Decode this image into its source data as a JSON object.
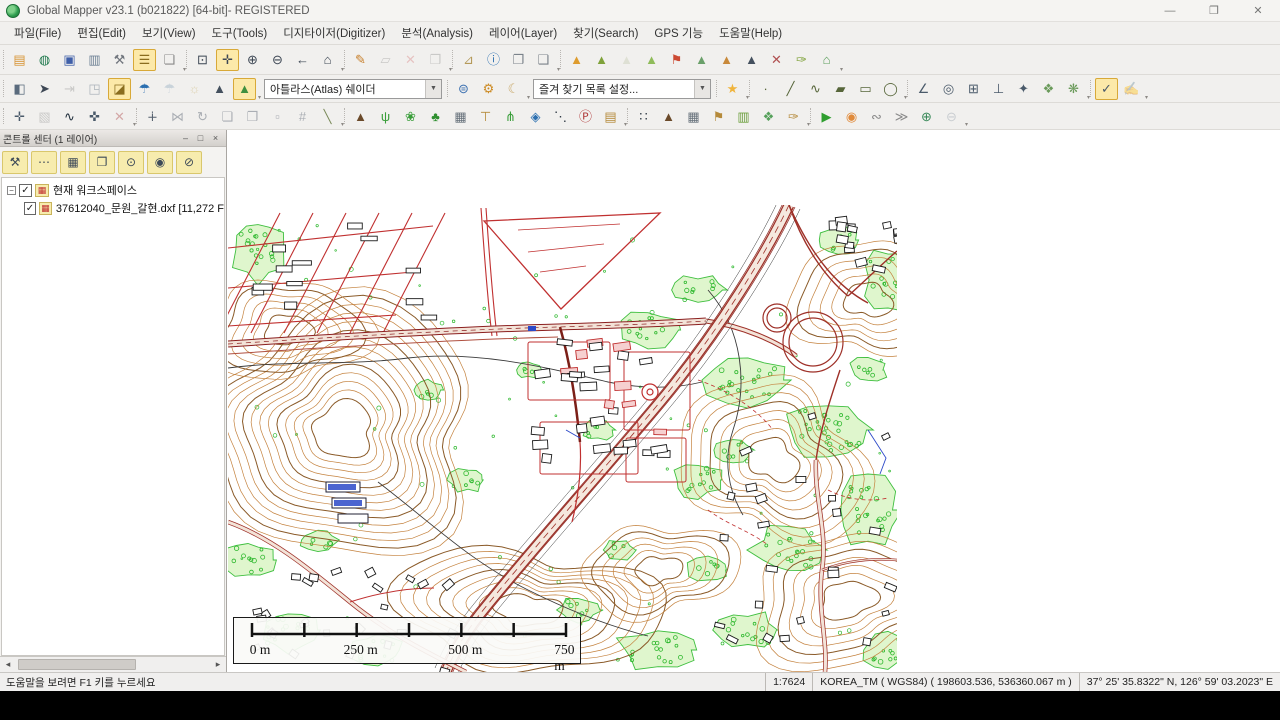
{
  "window": {
    "title": "Global Mapper v23.1 (b021822) [64-bit]- REGISTERED",
    "controls": {
      "minimize": "—",
      "restore": "❐",
      "close": "✕"
    }
  },
  "menu": {
    "items": [
      {
        "key": "file",
        "label": "파일(File)"
      },
      {
        "key": "edit",
        "label": "편집(Edit)"
      },
      {
        "key": "view",
        "label": "보기(View)"
      },
      {
        "key": "tools",
        "label": "도구(Tools)"
      },
      {
        "key": "digitizer",
        "label": "디지타이저(Digitizer)"
      },
      {
        "key": "analysis",
        "label": "분석(Analysis)"
      },
      {
        "key": "layer",
        "label": "레이어(Layer)"
      },
      {
        "key": "search",
        "label": "찾기(Search)"
      },
      {
        "key": "gps",
        "label": "GPS 기능"
      },
      {
        "key": "help",
        "label": "도움말(Help)"
      }
    ]
  },
  "toolbars": {
    "row1": [
      {
        "type": "group",
        "items": [
          {
            "n": "open-file",
            "g": "▤",
            "c": "#d79333"
          },
          {
            "n": "open-online-data",
            "g": "◍",
            "c": "#1f7a4d"
          },
          {
            "n": "save-workspace",
            "g": "▣",
            "c": "#3f5fa8"
          },
          {
            "n": "map-view",
            "g": "▥",
            "c": "#6b7f93"
          },
          {
            "n": "configuration",
            "g": "⚒",
            "c": "#70757d"
          },
          {
            "n": "control-center",
            "g": "☰",
            "c": "#8a6d1f",
            "a": true
          },
          {
            "n": "overlay-control-center",
            "g": "❏",
            "c": "#8a8a8a"
          }
        ]
      },
      {
        "type": "group",
        "items": [
          {
            "n": "zoom-box",
            "g": "⊡",
            "c": "#3d4754"
          },
          {
            "n": "pan-grab",
            "g": "✛",
            "c": "#3d4754",
            "a": true
          },
          {
            "n": "zoom-in",
            "g": "⊕",
            "c": "#3d4754"
          },
          {
            "n": "zoom-out",
            "g": "⊖",
            "c": "#3d4754"
          },
          {
            "n": "previous-view",
            "g": "←",
            "c": "#3d4754"
          },
          {
            "n": "full-view-home",
            "g": "⌂",
            "c": "#3d4754"
          }
        ]
      },
      {
        "type": "group",
        "items": [
          {
            "n": "digitizer-edit",
            "g": "✎",
            "c": "#c77f2a"
          },
          {
            "n": "edit-geometry",
            "g": "▱",
            "c": "#9a9a9a",
            "d": true
          },
          {
            "n": "delete-feature",
            "g": "✕",
            "c": "#d98c8c",
            "d": true
          },
          {
            "n": "multi-select",
            "g": "❒",
            "c": "#9a9a9a",
            "d": true
          }
        ]
      },
      {
        "type": "group",
        "items": [
          {
            "n": "measure",
            "g": "⊿",
            "c": "#b59a5a"
          },
          {
            "n": "feature-info",
            "g": "ⓘ",
            "c": "#2b6fb0"
          },
          {
            "n": "picture-info",
            "g": "❐",
            "c": "#7a828a"
          },
          {
            "n": "attribute-editor",
            "g": "❑",
            "c": "#7a828a"
          }
        ]
      },
      {
        "type": "group",
        "items": [
          {
            "n": "show-3d-view",
            "g": "▲",
            "c": "#de9c2e"
          },
          {
            "n": "path-profile",
            "g": "▲",
            "c": "#7fa23a"
          },
          {
            "n": "line-of-sight",
            "g": "▲",
            "c": "#c9cdb6",
            "d": true
          },
          {
            "n": "watershed",
            "g": "▲",
            "c": "#8fbc5a"
          },
          {
            "n": "view-shed-flag",
            "g": "⚑",
            "c": "#cc4a33"
          },
          {
            "n": "water-level-rise",
            "g": "▲",
            "c": "#6aa06a"
          },
          {
            "n": "contour-generation",
            "g": "▲",
            "c": "#c8893a"
          },
          {
            "n": "terrain-shading",
            "g": "▲",
            "c": "#44505e"
          },
          {
            "n": "clear-terrain",
            "g": "✕",
            "c": "#b05050"
          },
          {
            "n": "terrain-paint",
            "g": "✑",
            "c": "#7fa23a"
          },
          {
            "n": "3d-site-model",
            "g": "⌂",
            "c": "#5a9e5a"
          }
        ]
      }
    ],
    "row2": [
      {
        "type": "group",
        "items": [
          {
            "n": "split-screen",
            "g": "◧",
            "c": "#5a6b7d"
          },
          {
            "n": "gps-orientation",
            "g": "➤",
            "c": "#3d4754"
          },
          {
            "n": "step-playback",
            "g": "⇥",
            "c": "#9a9a9a",
            "d": true
          },
          {
            "n": "3d-path-view",
            "g": "◳",
            "c": "#5a6b7d",
            "d": true
          },
          {
            "n": "swipe-compare",
            "g": "◪",
            "c": "#8a6d1f",
            "a": true
          },
          {
            "n": "watershed-rain",
            "g": "☂",
            "c": "#2b6fb0"
          },
          {
            "n": "rain-simulation",
            "g": "☂",
            "c": "#9ab0c4",
            "d": true
          },
          {
            "n": "sun-shading",
            "g": "☼",
            "c": "#c8b06a",
            "d": true
          },
          {
            "n": "hill-shading",
            "g": "▲",
            "c": "#44505e"
          },
          {
            "n": "atlas-shader-mountain",
            "g": "▲",
            "c": "#3f8f3f",
            "a": true
          }
        ]
      },
      {
        "type": "combo",
        "n": "shader-combo",
        "value": "아틀라스(Atlas) 쉐이더"
      },
      {
        "type": "group",
        "items": [
          {
            "n": "online-sources-globe",
            "g": "⊜",
            "c": "#3a6fb0"
          },
          {
            "n": "shader-options-gear",
            "g": "⚙",
            "c": "#cc8a22"
          },
          {
            "n": "day-night-toggle-moon",
            "g": "☾",
            "c": "#c9a96a"
          }
        ]
      },
      {
        "type": "combo",
        "n": "favorites-combo",
        "value": "즐겨 찾기 목록 설정..."
      },
      {
        "type": "group",
        "items": [
          {
            "n": "favorite-views-star",
            "g": "★",
            "c": "#f0b43c"
          }
        ]
      },
      {
        "type": "group",
        "items": [
          {
            "n": "create-point-feature",
            "g": "∙",
            "c": "#57663a"
          },
          {
            "n": "create-line-feature",
            "g": "╱",
            "c": "#57663a"
          },
          {
            "n": "create-freehand-feature",
            "g": "∿",
            "c": "#57663a"
          },
          {
            "n": "create-area-feature",
            "g": "▰",
            "c": "#57663a"
          },
          {
            "n": "create-rectangle-feature",
            "g": "▭",
            "c": "#57663a"
          },
          {
            "n": "create-ellipse-feature",
            "g": "◯",
            "c": "#57663a"
          }
        ]
      },
      {
        "type": "group",
        "items": [
          {
            "n": "angle-measure-create",
            "g": "∠",
            "c": "#4a5a6a"
          },
          {
            "n": "range-rings",
            "g": "◎",
            "c": "#4a5a6a"
          },
          {
            "n": "grid-create",
            "g": "⊞",
            "c": "#4a5a6a"
          },
          {
            "n": "elevation-post",
            "g": "⊥",
            "c": "#4a5a6a"
          },
          {
            "n": "spot-symbol",
            "g": "✦",
            "c": "#4a5a6a"
          },
          {
            "n": "texture-fill",
            "g": "❖",
            "c": "#6a9a5a"
          },
          {
            "n": "merge-areas",
            "g": "❋",
            "c": "#6a9a5a"
          }
        ]
      },
      {
        "type": "group",
        "items": [
          {
            "n": "digitizer-select-check",
            "g": "✓",
            "c": "#4a5a6a",
            "a": true
          },
          {
            "n": "signature-stamp",
            "g": "✍",
            "c": "#9aa4ae",
            "d": true
          }
        ]
      }
    ],
    "row3": [
      {
        "type": "group",
        "items": [
          {
            "n": "move-feature",
            "g": "✛",
            "c": "#4a5a6a"
          },
          {
            "n": "image-rectify",
            "g": "▧",
            "c": "#9a9a9a",
            "d": true
          },
          {
            "n": "freehand-scribble",
            "g": "∿",
            "c": "#22303d"
          },
          {
            "n": "shift-vertices",
            "g": "✜",
            "c": "#4a5a6a"
          },
          {
            "n": "delete-vertex",
            "g": "✕",
            "c": "#b05050",
            "d": true
          }
        ]
      },
      {
        "type": "group",
        "items": [
          {
            "n": "add-vertex",
            "g": "∔",
            "c": "#55606e"
          },
          {
            "n": "join-lines",
            "g": "⋈",
            "c": "#55606e",
            "d": true
          },
          {
            "n": "rotate-feature",
            "g": "↻",
            "c": "#55606e",
            "d": true
          },
          {
            "n": "copy-feature",
            "g": "❏",
            "c": "#55606e",
            "d": true
          },
          {
            "n": "offset-feature",
            "g": "❐",
            "c": "#55606e",
            "d": true
          },
          {
            "n": "duplicate-feature",
            "g": "▫",
            "c": "#55606e",
            "d": true
          },
          {
            "n": "snap-to-grid",
            "g": "#",
            "c": "#55606e",
            "d": true
          },
          {
            "n": "draw-split-line",
            "g": "╲",
            "c": "#7a8a5a"
          }
        ]
      },
      {
        "type": "group",
        "items": [
          {
            "n": "symbol-mountain",
            "g": "▲",
            "c": "#6b4a2a"
          },
          {
            "n": "symbol-grass",
            "g": "ψ",
            "c": "#3a9e3a"
          },
          {
            "n": "symbol-shrub",
            "g": "❀",
            "c": "#3a9e3a"
          },
          {
            "n": "symbol-tree",
            "g": "♣",
            "c": "#2f8f2f"
          },
          {
            "n": "symbol-building",
            "g": "▦",
            "c": "#66707a"
          },
          {
            "n": "symbol-streetlamp",
            "g": "⊤",
            "c": "#b58a3a"
          },
          {
            "n": "symbol-palm",
            "g": "⋔",
            "c": "#3a9e3a"
          },
          {
            "n": "symbol-water-drop",
            "g": "◈",
            "c": "#2b6fb0"
          },
          {
            "n": "symbol-dotted-line",
            "g": "⋱",
            "c": "#2f3a44"
          },
          {
            "n": "symbol-parking",
            "g": "Ⓟ",
            "c": "#b03a3a"
          },
          {
            "n": "symbol-fence",
            "g": "▤",
            "c": "#b58a3a"
          }
        ]
      },
      {
        "type": "group",
        "items": [
          {
            "n": "label-point",
            "g": "∷",
            "c": "#2f3a44"
          },
          {
            "n": "label-mountain",
            "g": "▲",
            "c": "#6b4a2a"
          },
          {
            "n": "label-building",
            "g": "▦",
            "c": "#66707a"
          },
          {
            "n": "flag-pole",
            "g": "⚑",
            "c": "#b58a3a"
          },
          {
            "n": "billboard-panel",
            "g": "▥",
            "c": "#6a9e3a"
          },
          {
            "n": "texture-puzzle",
            "g": "❖",
            "c": "#55a05a"
          },
          {
            "n": "paint-brush",
            "g": "✑",
            "c": "#b58a3a"
          }
        ]
      },
      {
        "type": "group",
        "items": [
          {
            "n": "play-animation",
            "g": "▶",
            "c": "#2f9e2f"
          },
          {
            "n": "stop-animation",
            "g": "◉",
            "c": "#e08a3a"
          },
          {
            "n": "speed-slow-turtle",
            "g": "∾",
            "c": "#8a8a8a"
          },
          {
            "n": "speed-fast-rabbit",
            "g": "≫",
            "c": "#8a8a8a"
          },
          {
            "n": "zoom-in-animation",
            "g": "⊕",
            "c": "#3a8a5a"
          },
          {
            "n": "zoom-out-animation",
            "g": "⊖",
            "c": "#9aa4ae",
            "d": true
          }
        ]
      }
    ]
  },
  "control_center": {
    "title": "콘트롤 센터 (1 레이어)",
    "buttons": [
      {
        "n": "layer-options",
        "g": "⚒"
      },
      {
        "n": "layer-metadata",
        "g": "⋯"
      },
      {
        "n": "attribute-table",
        "g": "▦"
      },
      {
        "n": "duplicate-layer",
        "g": "❐"
      },
      {
        "n": "zoom-to-layer",
        "g": "⊙"
      },
      {
        "n": "show-layer-eye",
        "g": "◉"
      },
      {
        "n": "hide-layer-eye",
        "g": "⊘"
      }
    ],
    "window_buttons": {
      "minimize": "–",
      "restore": "□",
      "close": "×"
    },
    "tree": [
      {
        "label": "현재 워크스페이스",
        "checked": "✓",
        "indent": 0
      },
      {
        "label": "37612040_문원_갈현.dxf [11,272 F",
        "checked": "✓",
        "indent": 1
      }
    ]
  },
  "map": {
    "scale_labels": [
      "0 m",
      "250 m",
      "500 m",
      "750 m"
    ],
    "colors": {
      "contour": "#c4823e",
      "index_contour": "#8a5a28",
      "road_casing": "#9e3028",
      "road_fill": "#f3e3d8",
      "minor_road": "#c03030",
      "vegetation_fill": "#d9f5c4",
      "vegetation_stroke": "#3fbf3f",
      "building": "#1a1a1a",
      "water_blue": "#2b49c8"
    }
  },
  "statusbar": {
    "help": "도움말을 보려면 F1 키를 누르세요",
    "scale": "1:7624",
    "projection": "KOREA_TM ( WGS84) ( 198603.536, 536360.067 m )",
    "coordinates": "37° 25' 35.8322\" N, 126° 59' 03.2023\" E"
  }
}
